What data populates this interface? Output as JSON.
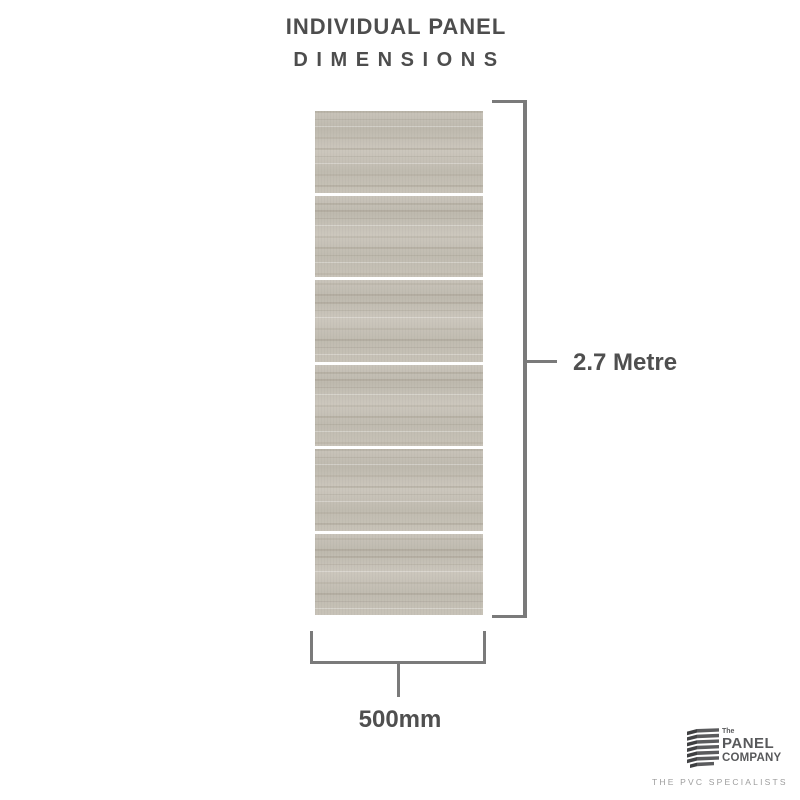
{
  "title": {
    "line1": "INDIVIDUAL PANEL",
    "line2": "D I M E N S I O N S"
  },
  "panel": {
    "segment_count": 6,
    "tile_color": "#c6c1b7",
    "gap_color": "#ffffff"
  },
  "dimensions": {
    "height_label": "2.7 Metre",
    "width_label": "500mm"
  },
  "logo": {
    "prefix": "The",
    "name_top": "PANEL",
    "name_bottom": "COMPANY",
    "tagline": "THE PVC SPECIALISTS"
  },
  "colors": {
    "dimension_line": "#7a7a7a",
    "dimension_text": "#4f4f4f",
    "title_text": "#4d4d4d",
    "logo_dark": "#58595b",
    "tagline_gray": "#9d9d9d"
  }
}
